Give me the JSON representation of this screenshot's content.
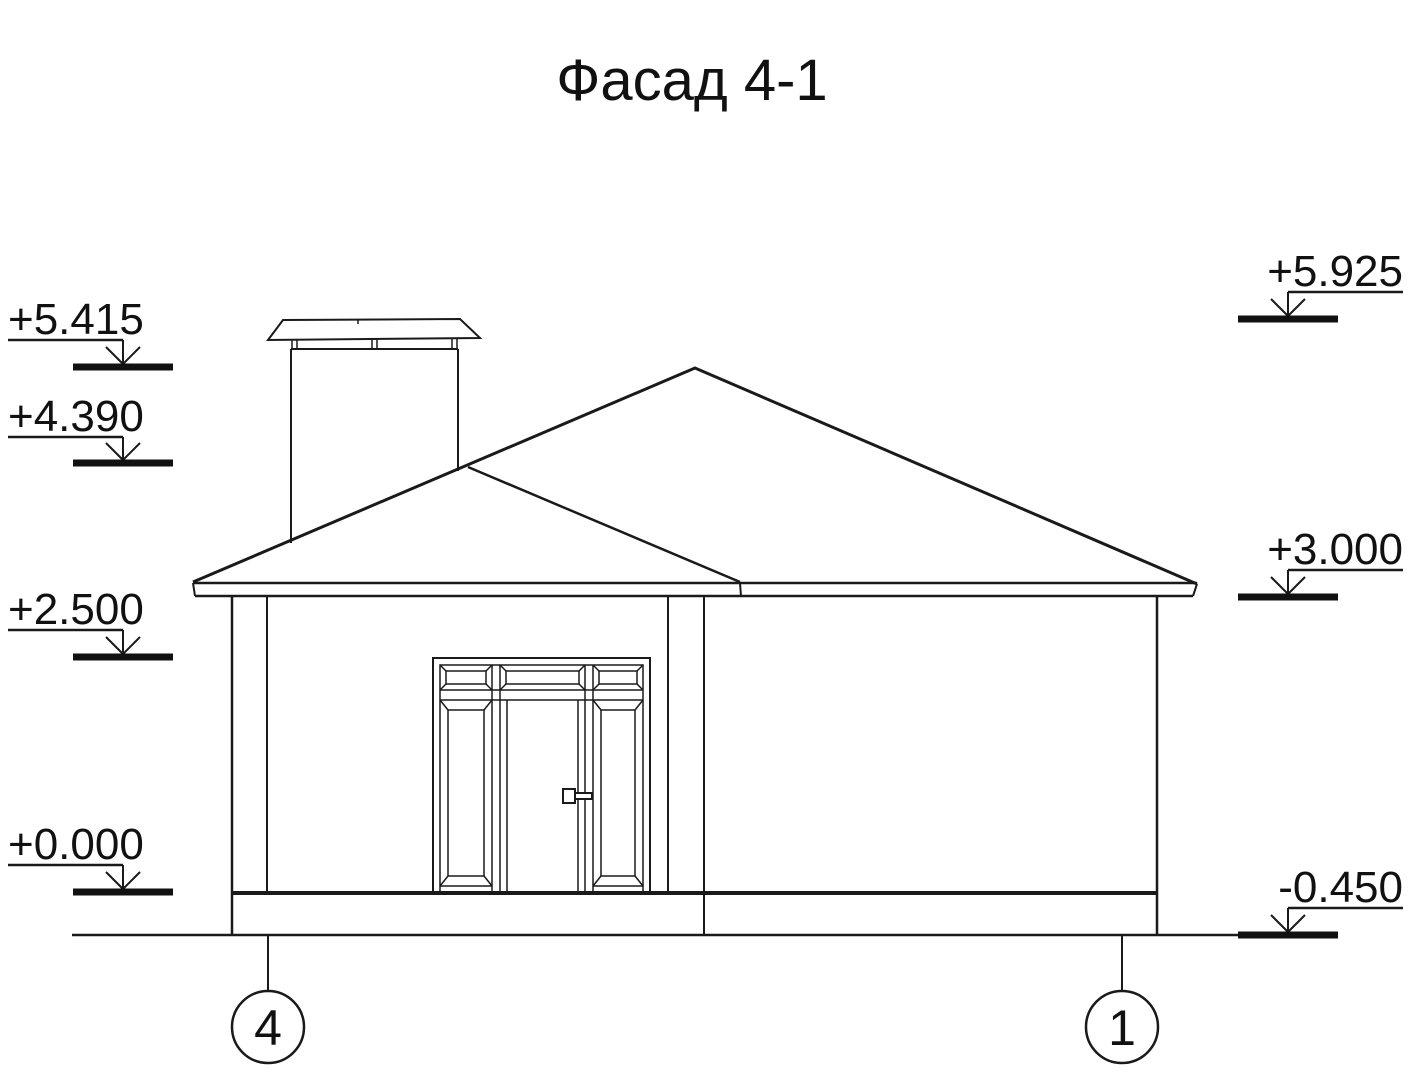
{
  "page": {
    "background": "#ffffff",
    "line_color": "#1a1a1a"
  },
  "drawing": {
    "title": "Фасад 4-1",
    "type": "architectural facade elevation, hip roof house with chimney and entrance door unit",
    "elevation_marks_left": [
      {
        "value": "+5.415"
      },
      {
        "value": "+4.390"
      },
      {
        "value": "+2.500"
      },
      {
        "value": "+0.000"
      }
    ],
    "elevation_marks_right": [
      {
        "value": "+5.925"
      },
      {
        "value": "+3.000"
      },
      {
        "value": "-0.450"
      }
    ],
    "axis_markers": [
      {
        "label": "4"
      },
      {
        "label": "1"
      }
    ]
  }
}
